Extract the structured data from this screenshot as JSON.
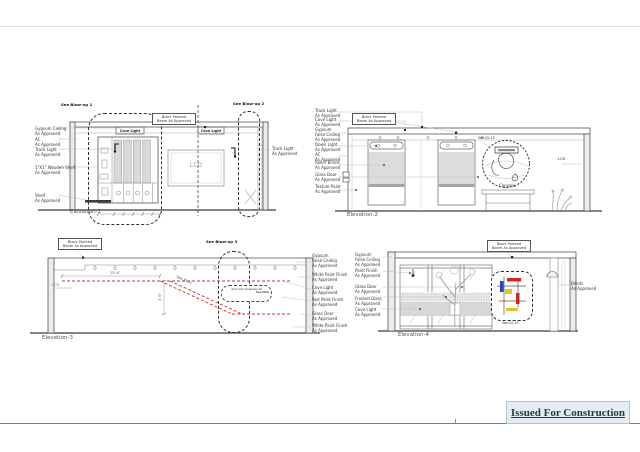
{
  "page": {
    "stamp": "Issued For Construction"
  },
  "colors": {
    "red_dash": "#c0392b",
    "mondrian_blue": "#2743c6",
    "mondrian_red": "#cf2a21",
    "mondrian_yellow": "#e6c419"
  },
  "el1": {
    "title": "Elevation-1",
    "see_blowup_1": "See Blow-up 1",
    "see_blowup_2": "See Blow-up 2",
    "beam": "Black Painted\nBeam As Approved",
    "cove_light_a": "Cove Light",
    "cove_light_b": "Cove Light",
    "lcd": "LCD",
    "labels": {
      "gypsum_ceiling": "Gypsum Ceiling\nAs Approved",
      "ac": "AC\nAs Approved",
      "track_light": "Track Light\nAs Approved",
      "wooden_shelf": "1\"X1\" Wooden Shelf\nAs Approved",
      "shelf": "Shelf\nAs Approved",
      "track_light_right": "Track Light\nAs Approved"
    }
  },
  "el2": {
    "title": "Elevation-2",
    "beam": "Black Painted\nBeam As Approved",
    "see_id": "See ID-13",
    "console": "Console",
    "lcd": "LCD",
    "labels": {
      "track_light": "Track Light\nAs Approved",
      "cove_light": "Cove Light\nAs Approved",
      "gypsum_false_ceiling": "Gypsum\nFalse Ceiling\nAs Approved",
      "down_light": "Down Light\nAs Approved",
      "ac": "AC\nAs Approved",
      "roller_blinds": "Roller Blinds\nAs Approved",
      "glass_door": "Glass Door\nAs Approved",
      "texture_paint": "Texture Paint\nAs Approved"
    }
  },
  "el3": {
    "title": "Elevation-3",
    "beam": "Black Painted\nBeam As Approved",
    "see_blowup_3": "See Blow-up 3",
    "see_id": "See ID-11",
    "lcd": "LCD",
    "dim_w": "13'-6\"",
    "dim_h": "3'-6\"",
    "note_line1": "don't why bookcase dtl",
    "note_line2": "See Note",
    "labels": {
      "gypsum_false_ceiling": "Gypsum\nFalse Ceiling\nAs Approved",
      "white_paint_1": "White Paint Finish\nAs Approved",
      "cove_light": "Cove Light\nAs Approved",
      "red_paint": "Red Paint Finish\nAs Approved",
      "glass_door": "Glass Door\nAs Approved",
      "white_paint_2": "White Paint Finish\nAs Approved"
    }
  },
  "el4": {
    "title": "Elevation-4",
    "beam": "Black Painted\nBeam As Approved",
    "see_id": "See ID-13",
    "labels": {
      "gypsum_false_ceiling": "Gypsum\nFalse Ceiling\nAs Approved",
      "paint_finish": "Paint Finish\nAs Approved",
      "glass_door": "Glass Door\nAs Approved",
      "frosted_glass": "Frosted Glass\nAs Approved",
      "cove_light": "Cove Light\nAs Approved",
      "blinds": "Blinds\nAs Approved"
    }
  }
}
